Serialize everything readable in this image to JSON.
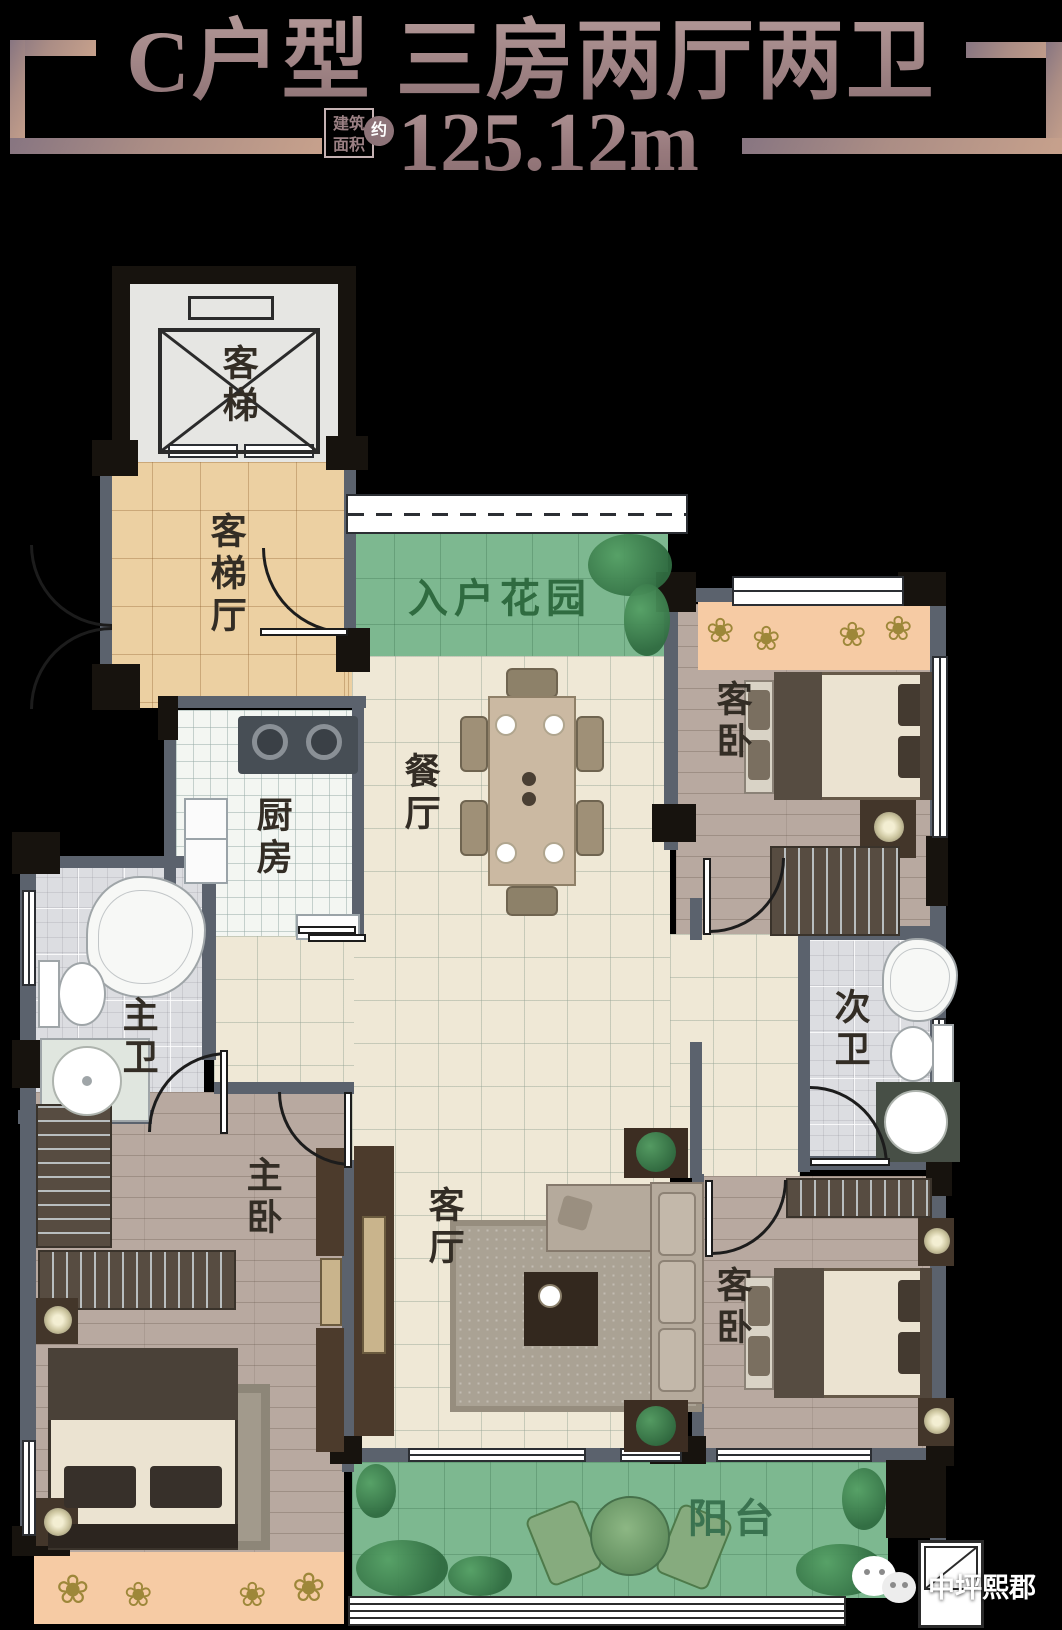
{
  "header": {
    "title": "C户型 三房两厅两卫",
    "badge": {
      "line1": "建筑",
      "line2": "面积",
      "circle": "约"
    },
    "area": {
      "value": "125.12m",
      "sup": "2"
    }
  },
  "rooms": {
    "elevator": {
      "label": "客梯"
    },
    "elevator_hall": {
      "label": "客梯厅"
    },
    "entry_garden": {
      "label": "入户花园"
    },
    "dining": {
      "label": "餐厅"
    },
    "kitchen": {
      "label": "厨房"
    },
    "guest_bedroom_top": {
      "label": "客卧"
    },
    "master_bath": {
      "label": "主卫"
    },
    "second_bath": {
      "label": "次卫"
    },
    "master_bedroom": {
      "label": "主卧"
    },
    "living": {
      "label": "客厅"
    },
    "guest_bedroom_bottom": {
      "label": "客卧"
    },
    "balcony": {
      "label": "阳台"
    }
  },
  "icons": {
    "flower": "❀"
  },
  "watermark": {
    "brand": "中坪熙郡"
  },
  "colors": {
    "title": "#a08587",
    "bracket": "#b08e81",
    "wall": "#5b626d",
    "column": "#17130e",
    "garden": "#7db890",
    "flowerbed": "#f6cba4",
    "cream": "#efe8d6",
    "wood": "#b8a9a0"
  }
}
